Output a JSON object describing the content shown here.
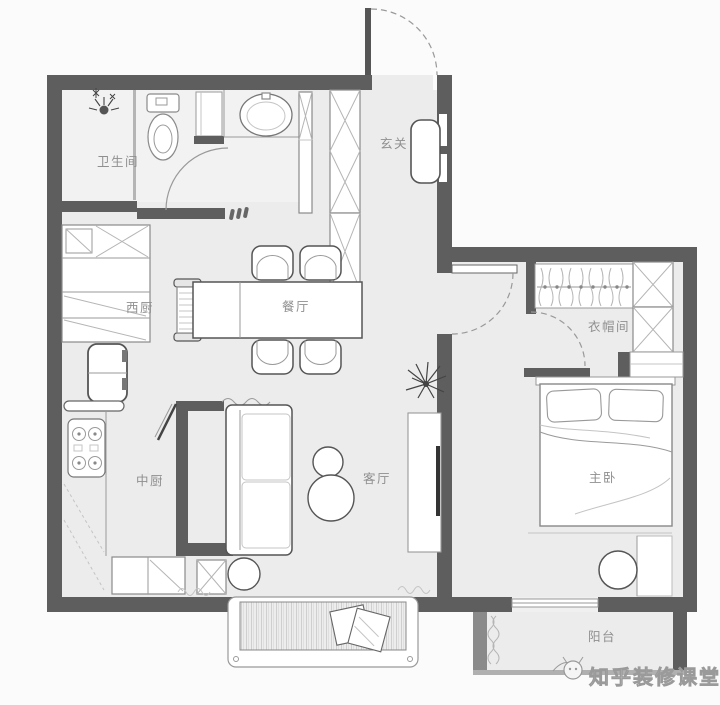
{
  "plan": {
    "rooms": {
      "bathroom": "卫生间",
      "entry": "玄关",
      "west_kitchen": "西厨",
      "dining": "餐厅",
      "chinese_kitchen": "中厨",
      "living": "客厅",
      "cloakroom": "衣帽间",
      "master_bedroom": "主卧",
      "balcony": "阳台"
    },
    "watermark": "知乎装修课堂",
    "colors": {
      "wall": "#5e5e5e",
      "floor": "#ececec",
      "bathroom_floor": "#f2f2f2",
      "background": "#fbfbfb",
      "label": "#8f8f8f",
      "watermark_fill": "#ededed",
      "watermark_stroke": "#9a9a9a"
    }
  }
}
